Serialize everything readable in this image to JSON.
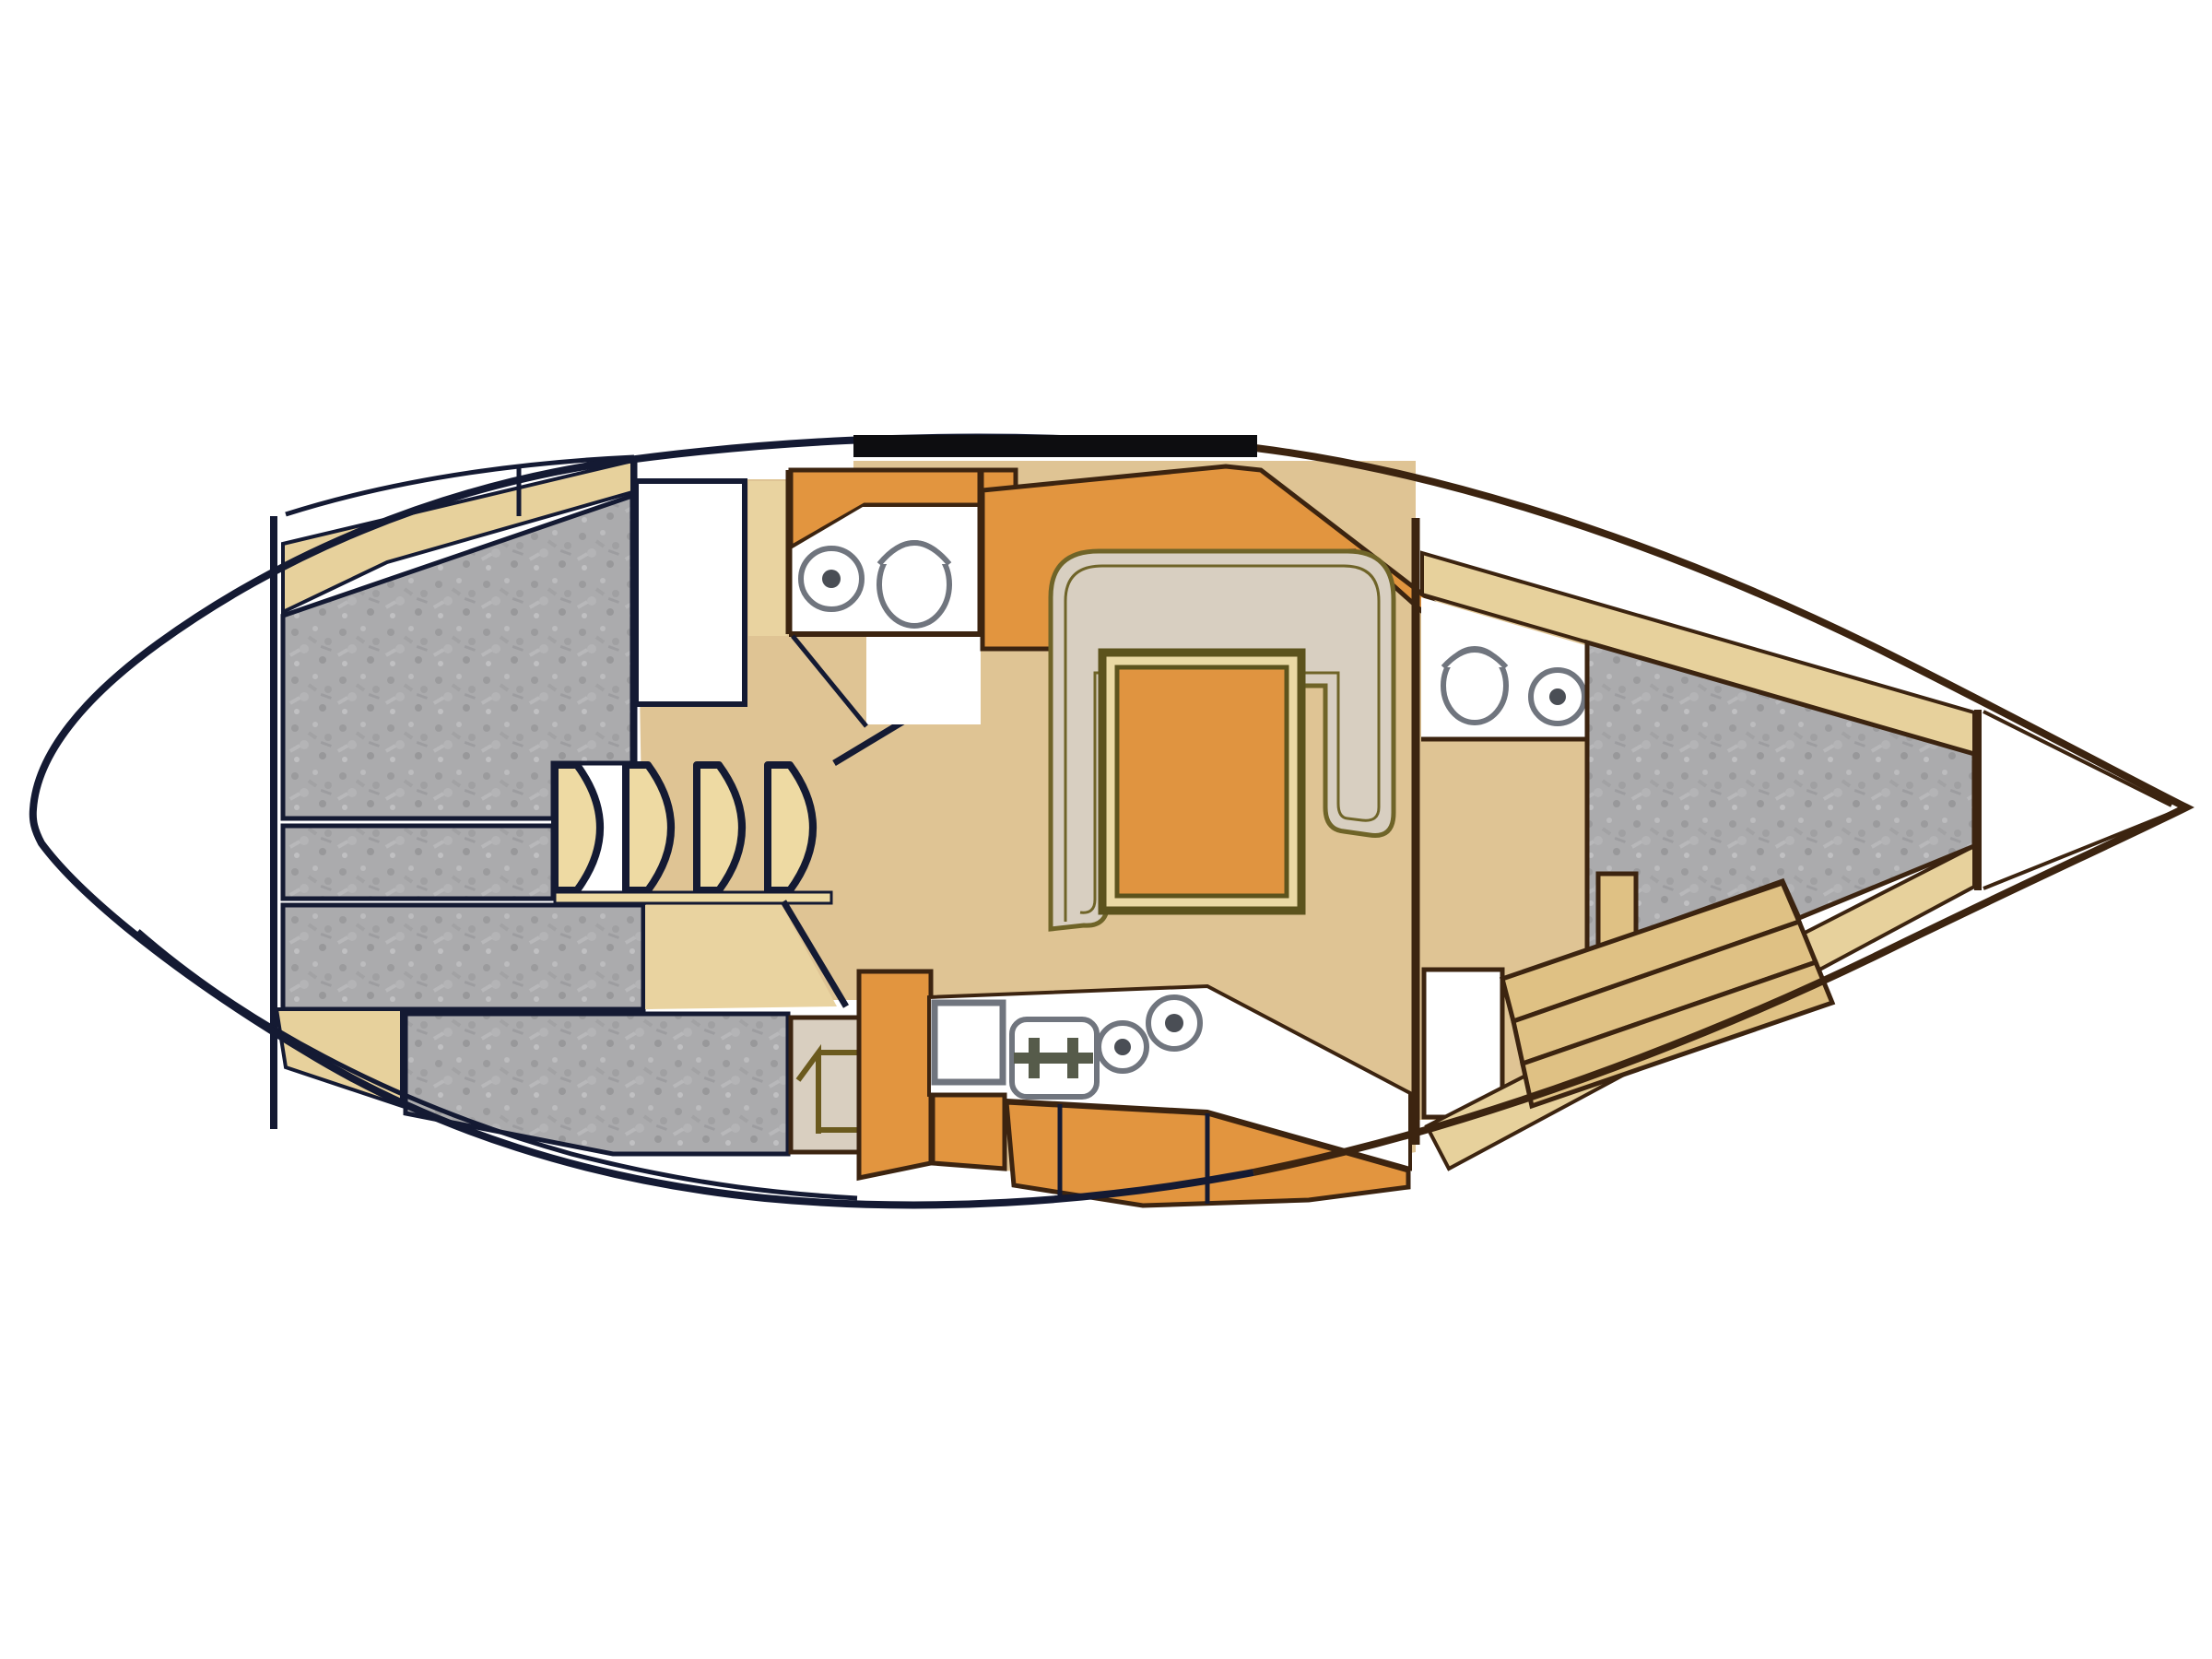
{
  "diagram": {
    "title": "Sailboat interior layout floor plan (top view)",
    "type": "yacht-deck-plan",
    "orientation": {
      "bow": "right",
      "stern": "left"
    },
    "colors": {
      "bg": "#ffffff",
      "hull_fill": "#ffffff",
      "line_navy": "#141a33",
      "line_brown": "#3c2410",
      "line_black": "#0d0d10",
      "floor_tan": "#dfc494",
      "floor_light": "#e9d3a0",
      "shelf_tan": "#e7d19c",
      "step_tan": "#eedaa3",
      "cabinet_orange": "#e2953f",
      "cushion_beige": "#d8cfc1",
      "cushion_gray": "#ababad",
      "seat_khaki": "#dfc184",
      "olive": "#6f6428",
      "fixture_gray": "#70757e",
      "burner_dark": "#565b4a"
    },
    "rooms": [
      {
        "id": "stern-deck",
        "label": "Stern deck / swim platform"
      },
      {
        "id": "aft-cabin",
        "label": "Aft cabin double berth"
      },
      {
        "id": "companionway-steps",
        "label": "Companionway steps (4 treads)"
      },
      {
        "id": "wardrobe",
        "label": "Hanging locker"
      },
      {
        "id": "aft-head",
        "label": "Aft head (sink + toilet)"
      },
      {
        "id": "salon-dinette",
        "label": "U-shaped dinette with table"
      },
      {
        "id": "galley",
        "label": "Galley (sink, 2-burner stove, 2 hobs)"
      },
      {
        "id": "nav-seat",
        "label": "Engine box / locker"
      },
      {
        "id": "port-settee",
        "label": "Port settee cushion"
      },
      {
        "id": "forward-head",
        "label": "Forward head (toilet + sink)"
      },
      {
        "id": "v-berth",
        "label": "Forward cabin V-berth"
      },
      {
        "id": "anchor-locker",
        "label": "Anchor locker / bow"
      }
    ],
    "fixtures": {
      "sinks_round": 3,
      "sinks_square": 1,
      "toilets": 2,
      "stove_burners": 2,
      "hob_rings": 2,
      "step_count": 4
    }
  }
}
